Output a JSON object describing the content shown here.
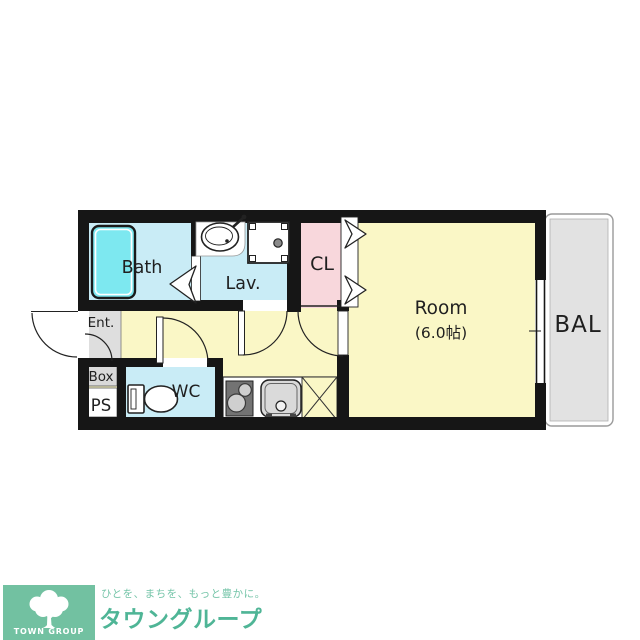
{
  "floorplan": {
    "bath_label": "Bath",
    "lav_label": "Lav.",
    "cl_label": "CL",
    "room_label": "Room",
    "room_size": "(6.0帖)",
    "bal_label": "BAL",
    "ent_label": "Ent.",
    "box_label": "Box",
    "ps_label": "PS",
    "wc_label": "WC",
    "colors": {
      "wall": "#161616",
      "floor_yellow": "#faf7c6",
      "wet_room_blue": "#c9ecf6",
      "bathtub_cyan": "#7de8f0",
      "closet_pink": "#f8d7dc",
      "entrance_gray": "#dedede",
      "balcony_gray": "#e2e2e2"
    }
  },
  "logo": {
    "square_label": "TOWN GROUP",
    "tagline": "ひとを、まちを、もっと豊かに。",
    "brand": "タウングループ",
    "square_green": "#72c1a1",
    "text_green": "#4fb596"
  }
}
